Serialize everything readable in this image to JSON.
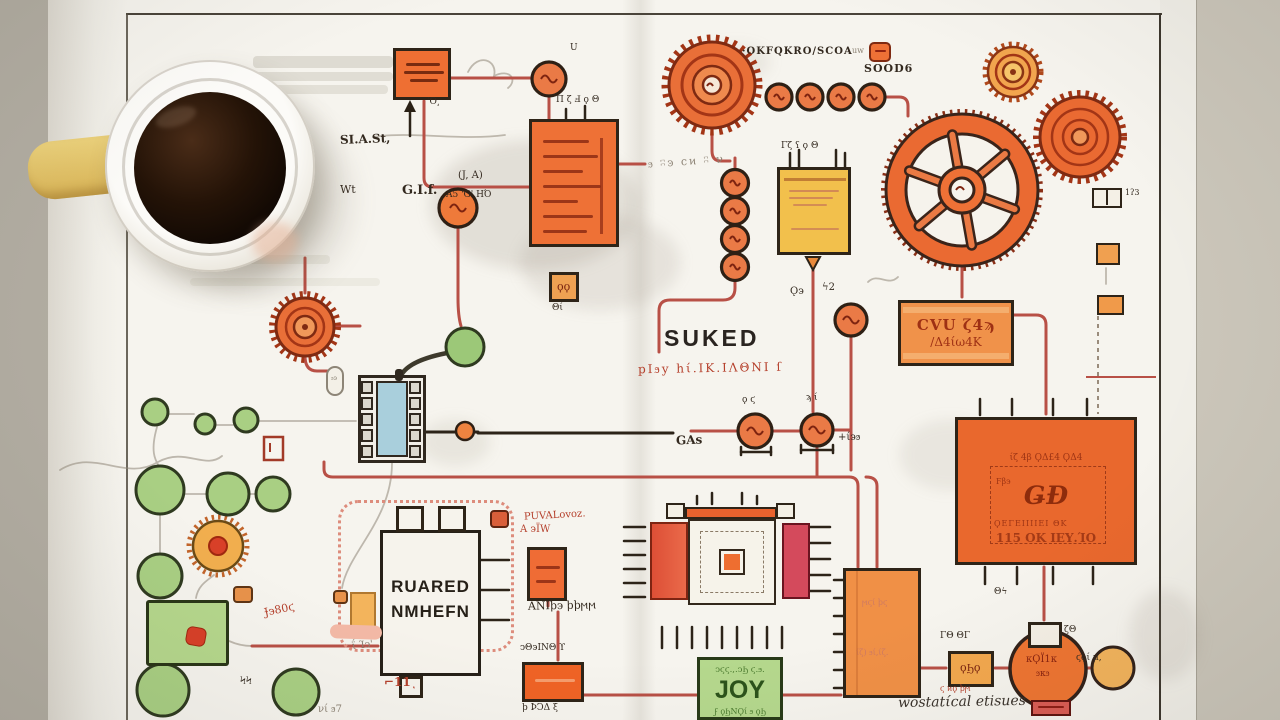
{
  "scene": {
    "colors": {
      "desk": "#b7b2a7",
      "desk_right": "#cbc6ba",
      "paper": "#f6f4ee",
      "orange": "#ee7136",
      "orange_gold": "#f0924a",
      "yellow": "#f2c14e",
      "green": "#a9cf83",
      "blue": "#a9cfdc",
      "crimson": "#d44a5c",
      "wire_red": "#b85046",
      "ink": "#33291f",
      "red_ink": "#b5402c",
      "coffee": "#1a0e06",
      "mug": "#f9f7f2",
      "handle_yellow": "#e5c76d"
    }
  },
  "labels": {
    "osc_title": "·OKFQKRO/SCOA",
    "osc_badge": "uw",
    "soods": "SOOD6",
    "start": "SI.A.St,",
    "wt": "Wt",
    "gif": "G.I.f.",
    "ja": "(J, A)",
    "a5": "A5 'G' ΗΌ",
    "o_mark": "'O͵",
    "u_mark": "U",
    "b_pins": "Π ζ Ⅎ   ϙ Θ",
    "suked": "SUKED",
    "suked_sub": "pΙϧy hί.ΙΚ.ΙΛΘΝΙ ſ",
    "squiggle_b": "ϧ ʭͽ ϲͷ ʭ ν",
    "gas": "GAs",
    "plus34": "+ί϶ϧ",
    "node1_top": "ϙ ϛ",
    "node2_top": "ϡ ί",
    "hash2": "ϟ2",
    "g_plus": "Ǫ϶",
    "cvu1": "CVU ζ4ϡ",
    "cvu2": "/Δ4ίω4Κ",
    "chip_title": "ίζ 4β ϘΔ£4 ϘΔ4",
    "chip_left": "Ϝβ϶",
    "chip_center": "ǤƉ",
    "chip_row": "ϘΕΓΕΙΙΙΙΕΙ ΘΚ",
    "chip_bottom": "115 ΟΚ ΙΕΥ.ΊΟ",
    "chip_below": "Θϟ",
    "r1_text1": "ϻϛί ϸϛ",
    "r1_text2": "ίζ) ϧί,ίζ.",
    "r2_top": "ΓΘ ΘΓ",
    "r2_inner": "ϙϦϙ",
    "r2_red": "ϛ ͷϙ ϸϻ",
    "r3_inner1": "κϘΪ1κ",
    "r3_inner2": "ϧκϧ",
    "r3_right": "ϛϙί μ,",
    "pinbox_label": "ζΘ",
    "onetwothree": "1ʔ3",
    "wostat": "wostatίcal etisues",
    "joy_top": "ͻϛϛ.,.ͻϦ ϛ.ϧ.",
    "joy": "JOY",
    "joy_bottom": "ϝ ϙϦΝϘί ϧ ϙϦ",
    "ruared1": "RUARED",
    "ruared2": "NMHEFN",
    "puvalovoz": "PUVALovoz.",
    "a2w": "A ϶ΪW",
    "ani": "ANΙϸ϶ ϸϸϻϻ",
    "o2_top": "ͻΘ϶ΙΝΘ ϒ",
    "o2_bottom": "ϸ ϷϽΔ ξ",
    "w1_pin_red": "⌐11ͺ",
    "jj80": "Ɉ϶80ϛ",
    "deg13": "ΐ Ίͻ'",
    "vr57": "νί ϧ7",
    "pp": "ϞϞ",
    "yellow_pins": "Γζ ʕ     ϙ Θ",
    "ot": "Θί",
    "ram": "ϧ϶",
    "small_dots": "ϙϙ"
  }
}
